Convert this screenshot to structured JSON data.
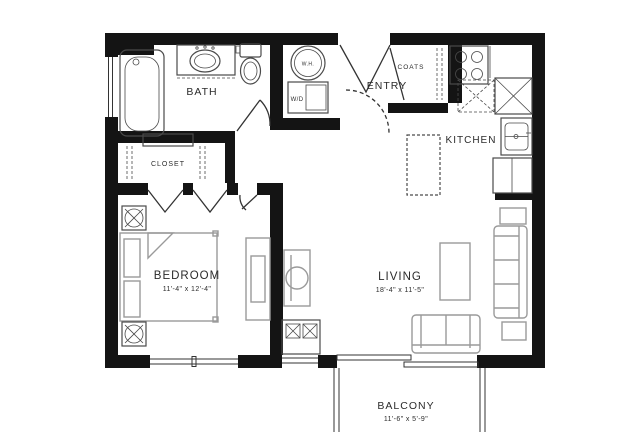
{
  "document": {
    "type": "apartment-floor-plan"
  },
  "rooms": {
    "bath": {
      "label": "BATH"
    },
    "closet": {
      "label": "CLOSET"
    },
    "entry": {
      "label": "ENTRY"
    },
    "coats": {
      "label": "COATS"
    },
    "kitchen": {
      "label": "KITCHEN"
    },
    "bedroom": {
      "label": "BEDROOM",
      "dimensions": "11'-4\" x 12'-4\""
    },
    "living": {
      "label": "LIVING",
      "dimensions": "18'-4\" x 11'-5\""
    },
    "balcony": {
      "label": "BALCONY",
      "dimensions": "11'-6\" x 5'-9\""
    }
  },
  "appliances": {
    "water_heater": {
      "label": "W.H."
    },
    "washer_dryer": {
      "label": "W/D"
    }
  },
  "colors": {
    "wall": "#141414",
    "fixture_line": "#4a4a4a",
    "furniture_line": "#9a9a9a",
    "door_line": "#333333",
    "background": "#ffffff",
    "text": "#2b2b2b"
  }
}
